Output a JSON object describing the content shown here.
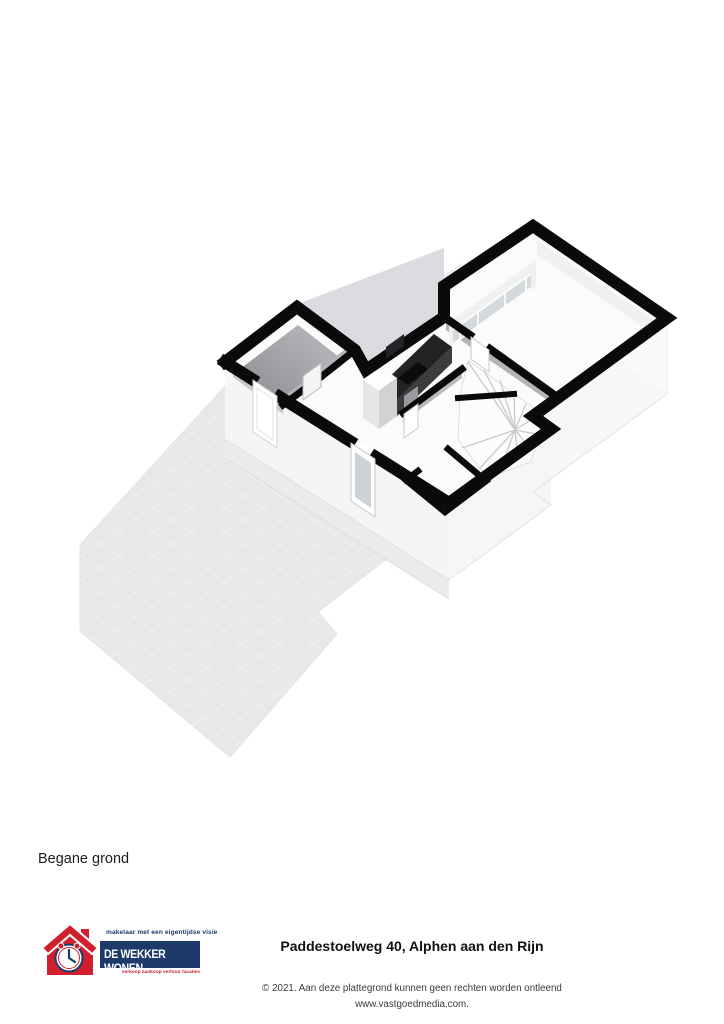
{
  "floor_label": "Begane grond",
  "footer": {
    "address_title": "Paddestoelweg 40, Alphen aan den Rijn",
    "copyright_line": "© 2021. Aan deze plattegrond kunnen geen rechten worden ontleend",
    "website_line": "www.vastgoedmedia.com.",
    "logo": {
      "tagline": "makelaar met een eigentijdse visie",
      "brand_name": "DE WEKKER WONEN",
      "services": "verkoop aankoop verhuur taxaties",
      "brand_red": "#d0202e",
      "brand_navy": "#1d3a6b"
    }
  },
  "floorplan": {
    "kind": "3d-floorplan-ground-floor",
    "colors": {
      "wall_top": "#0a0a0a",
      "floor": "#fbfbfc",
      "storage_floor": "#94959a",
      "terrace_tile": "#e8e8ea",
      "terrace_grout": "#f2f2f4",
      "flat_area": "#dbdcdf",
      "exterior_face": "#f5f5f6",
      "interior_face": "#b3b4b7",
      "glass": "#d5d9dc",
      "counter_top": "#232325",
      "counter_face": "#3c3c3f"
    }
  }
}
